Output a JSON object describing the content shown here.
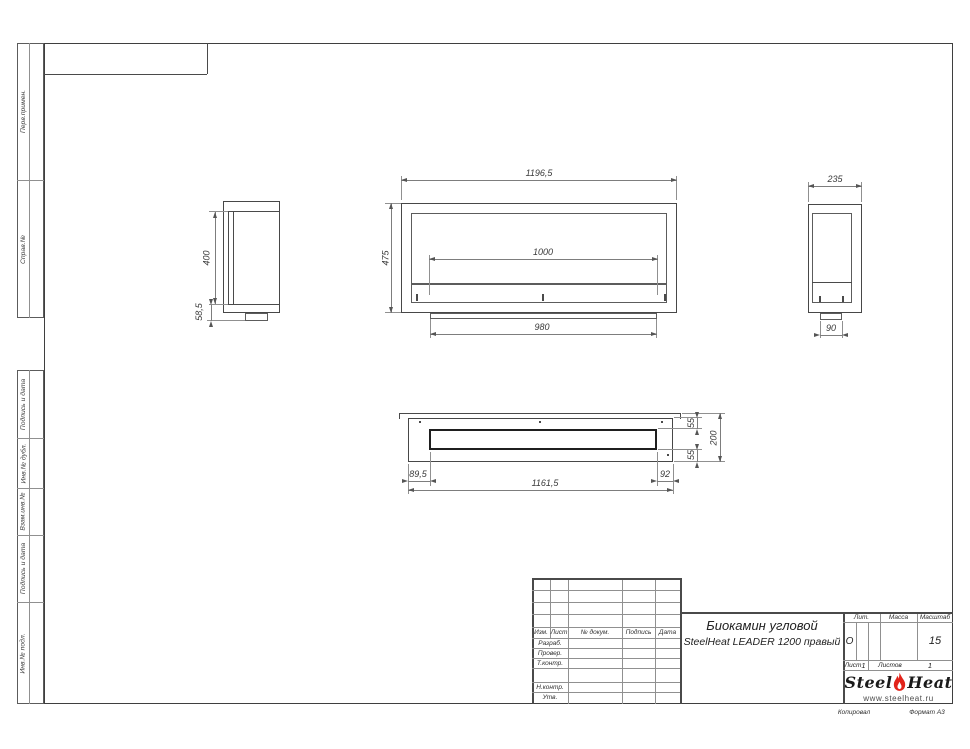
{
  "margin_labels": [
    "Перв.примен.",
    "Справ.№",
    "Подпись и дата",
    "Инв.№ дубл.",
    "Взам.инв.№",
    "Подпись и дата",
    "Инв.№ подл."
  ],
  "dimensions": {
    "front_width": "1196,5",
    "front_height": "475",
    "front_burner": "1000",
    "front_base": "980",
    "left_opening": "400",
    "left_bottom": "58,5",
    "right_depth": "235",
    "right_foot": "90",
    "plan_left": "89,5",
    "plan_length": "1161,5",
    "plan_right": "92",
    "plan_front": "55",
    "plan_back": "55",
    "plan_depth": "200"
  },
  "title_block": {
    "rev_header": [
      "Изм.",
      "Лист",
      "№ докум.",
      "Подпись",
      "Дата"
    ],
    "row_labels": [
      "Разраб.",
      "Провер.",
      "Т.контр.",
      "Н.контр.",
      "Утв."
    ],
    "lit_label": "Лит.",
    "mass_label": "Масса",
    "scale_label": "Масштаб",
    "lit_value": "О",
    "scale_value": "15",
    "title_line1": "Биокамин угловой",
    "title_line2": "SteelHeat LEADER 1200 правый",
    "sheet_label": "Лист",
    "sheet_value": "1",
    "sheets_label": "Листов",
    "sheets_value": "1"
  },
  "logo": {
    "brand_steel": "Steel",
    "brand_heat": "Heat",
    "website": "www.steelheat.ru"
  },
  "footer": {
    "copied": "Копировал",
    "format": "Формат А3"
  },
  "colors": {
    "line": "#4a4a4a",
    "dim": "#7d7d7d",
    "accent_red": "#e2231a"
  }
}
